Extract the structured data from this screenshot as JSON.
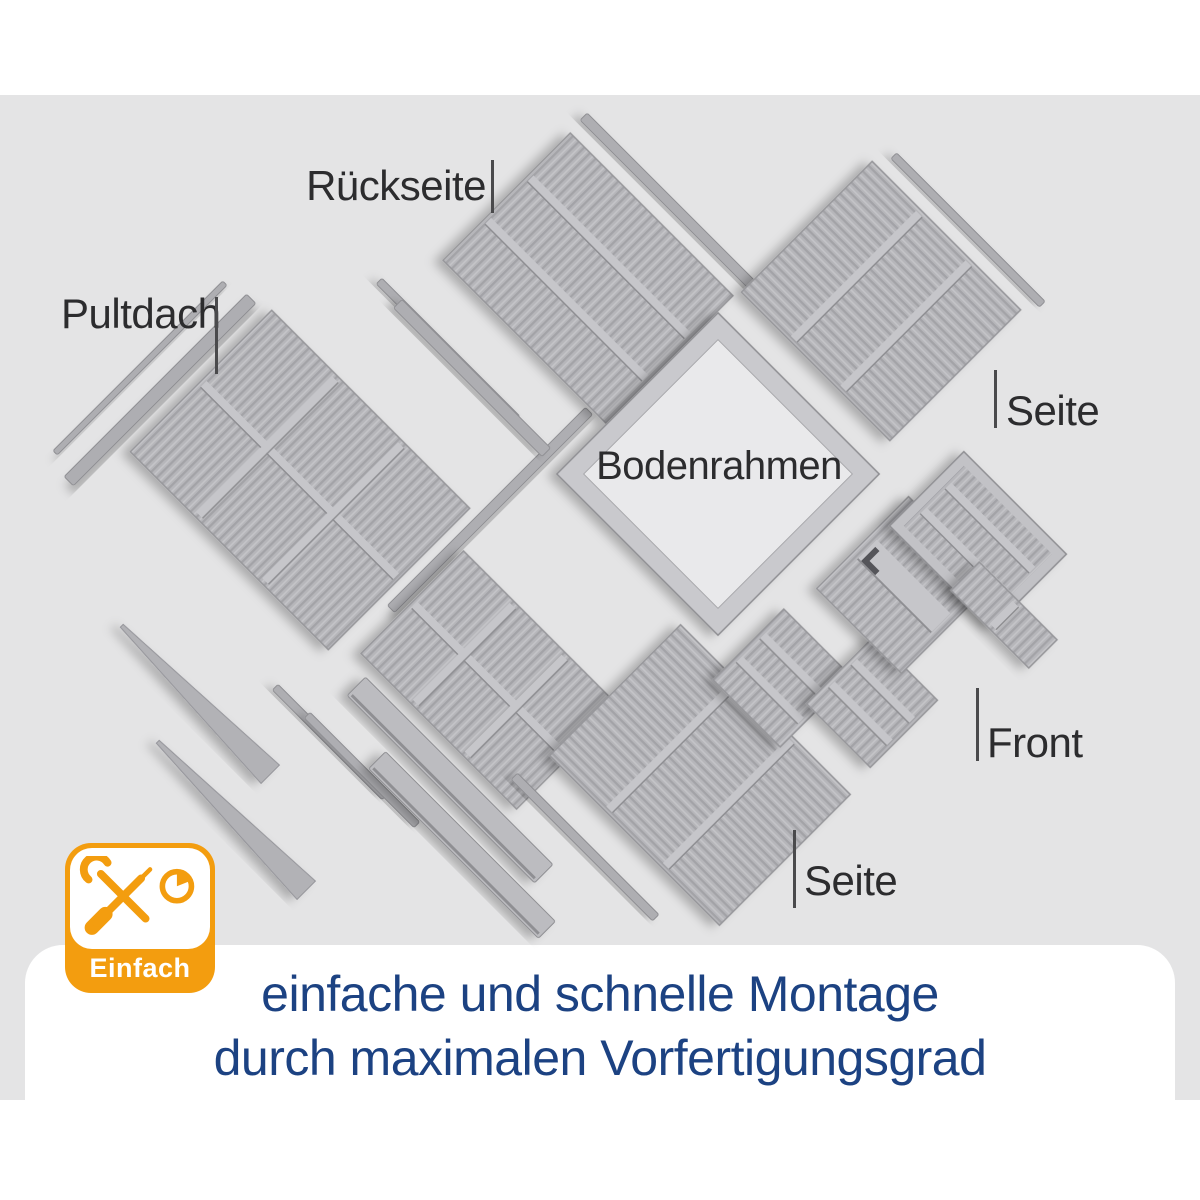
{
  "diagram": {
    "labels": {
      "rueckseite": "Rückseite",
      "pultdach": "Pultdach",
      "seite_right": "Seite",
      "bodenrahmen": "Bodenrahmen",
      "front": "Front",
      "seite_bottom": "Seite"
    }
  },
  "badge": {
    "label": "Einfach",
    "accent_color": "#f39d0f",
    "icons": [
      "wrench-icon",
      "screwdriver-icon",
      "timer-icon"
    ]
  },
  "caption": {
    "line1": "einfache und schnelle Montage",
    "line2": "durch maximalen Vorfertigungsgrad",
    "color": "#1c4282"
  },
  "colors": {
    "background": "#e4e4e5",
    "panel": "#b6b6ba",
    "panel_dark": "#a3a3a7",
    "panel_light": "#c4c4c8",
    "label_text": "#2c2c2e"
  }
}
